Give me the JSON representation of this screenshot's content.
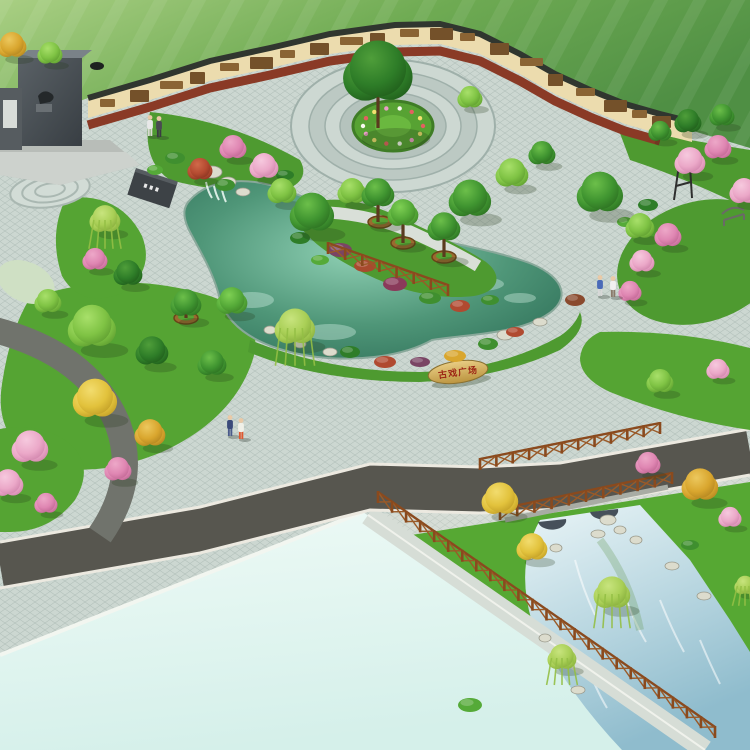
{
  "scene": {
    "kind": "park-landscape-render",
    "stone": {
      "text": "古戏广场",
      "text_color": "#9c2414"
    },
    "palette": {
      "field_light": "#a9cf83",
      "field_dark": "#4f8f44",
      "paving": "#ccd7d1",
      "paving_line": "#b4c2bc",
      "road": "#57564f",
      "curb": "#ece9e0",
      "pool_pale": "#e4f6f1",
      "pond_deep": "#2e6f58",
      "pond_light": "#8fd0b4",
      "canal_light": "#eaf5f7",
      "canal_deep": "#8fbccd",
      "lawn": "#55a433",
      "lawn_deep": "#4e9a30",
      "wall_face": "#ecdcae",
      "wall_coping": "#30362f",
      "mulch": "#8a3a26",
      "mural_a": "#8a6434",
      "mural_b": "#74512a",
      "fence": "#8a4a1e",
      "fence_x": "#9a5a28",
      "rock": "#dcdccd",
      "rock_edge": "#9a9a8c",
      "planter": "#9a6a30",
      "trunk": "#5a3a1e",
      "skin": "#eac9a6",
      "trees": {
        "green_dark": {
          "l": "#4f9e3a",
          "b": "#2e7d28",
          "d": "#1c5417"
        },
        "green": {
          "l": "#6cbf4a",
          "b": "#3f9430",
          "d": "#27661d"
        },
        "green_mid": {
          "l": "#7fd054",
          "b": "#55aa38",
          "d": "#3a7d24"
        },
        "green_light": {
          "l": "#a8e06a",
          "b": "#7fc344",
          "d": "#55932a"
        },
        "yellow": {
          "l": "#f2dc6e",
          "b": "#e2c23c",
          "d": "#b89420"
        },
        "gold": {
          "l": "#ecc85e",
          "b": "#d9a62e",
          "d": "#a87c1c"
        },
        "pink": {
          "l": "#f6c9de",
          "b": "#eba8c8",
          "d": "#c97aa4"
        },
        "pink_deep": {
          "l": "#eda8c8",
          "b": "#df86b2",
          "d": "#b85e8c"
        },
        "red": {
          "l": "#d06a4a",
          "b": "#b44a30",
          "d": "#7d2e1c"
        },
        "willow": {
          "l": "#c8e47e",
          "b": "#a9cf56",
          "d": "#7da436"
        }
      }
    },
    "wall_murals": [
      {
        "x": 100,
        "y": 99
      },
      {
        "x": 130,
        "y": 90
      },
      {
        "x": 160,
        "y": 81
      },
      {
        "x": 190,
        "y": 72
      },
      {
        "x": 220,
        "y": 63
      },
      {
        "x": 250,
        "y": 57
      },
      {
        "x": 280,
        "y": 50
      },
      {
        "x": 310,
        "y": 43
      },
      {
        "x": 340,
        "y": 37
      },
      {
        "x": 370,
        "y": 33
      },
      {
        "x": 400,
        "y": 29
      },
      {
        "x": 430,
        "y": 28
      },
      {
        "x": 460,
        "y": 33
      },
      {
        "x": 490,
        "y": 43
      },
      {
        "x": 520,
        "y": 58
      },
      {
        "x": 548,
        "y": 74
      },
      {
        "x": 576,
        "y": 88
      },
      {
        "x": 604,
        "y": 100
      },
      {
        "x": 632,
        "y": 110
      },
      {
        "x": 652,
        "y": 116
      }
    ],
    "plaza_ring": {
      "cx": 393,
      "cy": 126,
      "rx": 30,
      "ry": 18,
      "count": 14,
      "colors": [
        "#e46060",
        "#f2e070",
        "#eb9ec6",
        "#f8f8f0"
      ]
    },
    "trees": [
      {
        "x": 12,
        "y": 46,
        "r": 15,
        "t": "gold"
      },
      {
        "x": 50,
        "y": 54,
        "r": 13,
        "t": "green_light"
      },
      {
        "x": 378,
        "y": 74,
        "r": 36,
        "t": "green_dark",
        "trunk": 54
      },
      {
        "x": 688,
        "y": 122,
        "r": 14,
        "t": "green_dark"
      },
      {
        "x": 722,
        "y": 116,
        "r": 13,
        "t": "green"
      },
      {
        "x": 660,
        "y": 132,
        "r": 12,
        "t": "green"
      },
      {
        "x": 470,
        "y": 98,
        "r": 13,
        "t": "green_light"
      },
      {
        "x": 200,
        "y": 170,
        "r": 13,
        "t": "red"
      },
      {
        "x": 233,
        "y": 148,
        "r": 14,
        "t": "pink_deep"
      },
      {
        "x": 264,
        "y": 167,
        "r": 15,
        "t": "pink"
      },
      {
        "x": 105,
        "y": 220,
        "r": 16,
        "t": "willow"
      },
      {
        "x": 95,
        "y": 260,
        "r": 13,
        "t": "pink_deep"
      },
      {
        "x": 128,
        "y": 274,
        "r": 15,
        "t": "green_dark"
      },
      {
        "x": 312,
        "y": 214,
        "r": 23,
        "t": "green"
      },
      {
        "x": 282,
        "y": 192,
        "r": 15,
        "t": "green_light"
      },
      {
        "x": 352,
        "y": 192,
        "r": 15,
        "t": "green_light"
      },
      {
        "x": 378,
        "y": 194,
        "r": 17,
        "t": "green",
        "trunk": 28
      },
      {
        "x": 403,
        "y": 214,
        "r": 16,
        "t": "green_mid",
        "trunk": 29
      },
      {
        "x": 444,
        "y": 228,
        "r": 17,
        "t": "green",
        "trunk": 29
      },
      {
        "x": 470,
        "y": 200,
        "r": 22,
        "t": "green"
      },
      {
        "x": 512,
        "y": 174,
        "r": 17,
        "t": "green_light"
      },
      {
        "x": 542,
        "y": 154,
        "r": 14,
        "t": "green"
      },
      {
        "x": 295,
        "y": 328,
        "r": 21,
        "t": "willow"
      },
      {
        "x": 600,
        "y": 194,
        "r": 24,
        "t": "green"
      },
      {
        "x": 640,
        "y": 227,
        "r": 15,
        "t": "green_light"
      },
      {
        "x": 668,
        "y": 236,
        "r": 14,
        "t": "pink_deep"
      },
      {
        "x": 642,
        "y": 262,
        "r": 13,
        "t": "pink"
      },
      {
        "x": 630,
        "y": 292,
        "r": 12,
        "t": "pink_deep"
      },
      {
        "x": 690,
        "y": 162,
        "r": 16,
        "t": "pink"
      },
      {
        "x": 718,
        "y": 148,
        "r": 14,
        "t": "pink_deep"
      },
      {
        "x": 744,
        "y": 192,
        "r": 15,
        "t": "pink"
      },
      {
        "x": 660,
        "y": 382,
        "r": 14,
        "t": "green_light"
      },
      {
        "x": 718,
        "y": 370,
        "r": 12,
        "t": "pink"
      },
      {
        "x": 92,
        "y": 328,
        "r": 25,
        "t": "green_light"
      },
      {
        "x": 48,
        "y": 302,
        "r": 14,
        "t": "green_light"
      },
      {
        "x": 186,
        "y": 304,
        "r": 16,
        "t": "green",
        "trunk": 14
      },
      {
        "x": 232,
        "y": 302,
        "r": 16,
        "t": "green_mid"
      },
      {
        "x": 152,
        "y": 352,
        "r": 17,
        "t": "green_dark"
      },
      {
        "x": 212,
        "y": 364,
        "r": 15,
        "t": "green"
      },
      {
        "x": 95,
        "y": 400,
        "r": 23,
        "t": "yellow"
      },
      {
        "x": 150,
        "y": 434,
        "r": 16,
        "t": "gold"
      },
      {
        "x": 30,
        "y": 448,
        "r": 19,
        "t": "pink"
      },
      {
        "x": 118,
        "y": 470,
        "r": 14,
        "t": "pink_deep"
      },
      {
        "x": 8,
        "y": 484,
        "r": 16,
        "t": "pink"
      },
      {
        "x": 46,
        "y": 504,
        "r": 12,
        "t": "pink_deep"
      },
      {
        "x": 500,
        "y": 500,
        "r": 19,
        "t": "yellow"
      },
      {
        "x": 648,
        "y": 464,
        "r": 13,
        "t": "pink_deep"
      },
      {
        "x": 700,
        "y": 486,
        "r": 19,
        "t": "gold"
      },
      {
        "x": 730,
        "y": 518,
        "r": 12,
        "t": "pink"
      },
      {
        "x": 532,
        "y": 548,
        "r": 16,
        "t": "yellow"
      },
      {
        "x": 612,
        "y": 594,
        "r": 19,
        "t": "willow"
      },
      {
        "x": 562,
        "y": 658,
        "r": 15,
        "t": "willow"
      },
      {
        "x": 745,
        "y": 586,
        "r": 11,
        "t": "willow"
      }
    ],
    "planters": [
      {
        "x": 380,
        "y": 222
      },
      {
        "x": 403,
        "y": 243
      },
      {
        "x": 444,
        "y": 257
      },
      {
        "x": 186,
        "y": 318
      }
    ],
    "shrubs": [
      {
        "x": 175,
        "y": 158,
        "rx": 10,
        "ry": 6,
        "c": "#3f8f2f"
      },
      {
        "x": 155,
        "y": 170,
        "rx": 8,
        "ry": 5,
        "c": "#55aa38"
      },
      {
        "x": 285,
        "y": 175,
        "rx": 9,
        "ry": 5,
        "c": "#2e7d28"
      },
      {
        "x": 225,
        "y": 185,
        "rx": 10,
        "ry": 6,
        "c": "#3f8f2f"
      },
      {
        "x": 340,
        "y": 250,
        "rx": 12,
        "ry": 7,
        "c": "#7a4464"
      },
      {
        "x": 365,
        "y": 266,
        "rx": 11,
        "ry": 6,
        "c": "#a84a2e"
      },
      {
        "x": 395,
        "y": 284,
        "rx": 12,
        "ry": 7,
        "c": "#8a3a5a"
      },
      {
        "x": 430,
        "y": 298,
        "rx": 11,
        "ry": 6,
        "c": "#3f8f2f"
      },
      {
        "x": 300,
        "y": 238,
        "rx": 10,
        "ry": 6,
        "c": "#2e7d28"
      },
      {
        "x": 320,
        "y": 260,
        "rx": 9,
        "ry": 5,
        "c": "#55aa38"
      },
      {
        "x": 460,
        "y": 306,
        "rx": 10,
        "ry": 6,
        "c": "#b04a30"
      },
      {
        "x": 490,
        "y": 300,
        "rx": 9,
        "ry": 5,
        "c": "#3f8f2f"
      },
      {
        "x": 350,
        "y": 352,
        "rx": 10,
        "ry": 6,
        "c": "#2e7d28"
      },
      {
        "x": 385,
        "y": 362,
        "rx": 11,
        "ry": 6,
        "c": "#b04a30"
      },
      {
        "x": 420,
        "y": 362,
        "rx": 10,
        "ry": 5,
        "c": "#7a4464"
      },
      {
        "x": 455,
        "y": 356,
        "rx": 11,
        "ry": 6,
        "c": "#d9a62e"
      },
      {
        "x": 488,
        "y": 344,
        "rx": 10,
        "ry": 6,
        "c": "#3f8f2f"
      },
      {
        "x": 515,
        "y": 332,
        "rx": 9,
        "ry": 5,
        "c": "#b04a30"
      },
      {
        "x": 575,
        "y": 300,
        "rx": 10,
        "ry": 6,
        "c": "#8a4a2e"
      },
      {
        "x": 648,
        "y": 205,
        "rx": 10,
        "ry": 6,
        "c": "#2e7d28"
      },
      {
        "x": 625,
        "y": 222,
        "rx": 8,
        "ry": 5,
        "c": "#55aa38"
      },
      {
        "x": 690,
        "y": 545,
        "rx": 9,
        "ry": 5,
        "c": "#3f8f2f"
      },
      {
        "x": 470,
        "y": 705,
        "rx": 12,
        "ry": 7,
        "c": "#55aa38"
      }
    ],
    "rocks": [
      {
        "x": 212,
        "y": 172,
        "rx": 10,
        "ry": 6
      },
      {
        "x": 228,
        "y": 182,
        "rx": 8,
        "ry": 5
      },
      {
        "x": 243,
        "y": 192,
        "rx": 7,
        "ry": 4
      },
      {
        "x": 330,
        "y": 352,
        "rx": 7,
        "ry": 4
      },
      {
        "x": 300,
        "y": 344,
        "rx": 6,
        "ry": 4
      },
      {
        "x": 505,
        "y": 335,
        "rx": 8,
        "ry": 5
      },
      {
        "x": 540,
        "y": 322,
        "rx": 7,
        "ry": 4
      },
      {
        "x": 270,
        "y": 330,
        "rx": 6,
        "ry": 4
      },
      {
        "x": 528,
        "y": 556,
        "rx": 7,
        "ry": 4
      },
      {
        "x": 556,
        "y": 548,
        "rx": 6,
        "ry": 4
      },
      {
        "x": 598,
        "y": 534,
        "rx": 7,
        "ry": 4
      },
      {
        "x": 636,
        "y": 540,
        "rx": 6,
        "ry": 4
      },
      {
        "x": 672,
        "y": 566,
        "rx": 7,
        "ry": 4
      },
      {
        "x": 704,
        "y": 596,
        "rx": 7,
        "ry": 4
      },
      {
        "x": 545,
        "y": 638,
        "rx": 6,
        "ry": 4
      },
      {
        "x": 578,
        "y": 690,
        "rx": 7,
        "ry": 4
      },
      {
        "x": 620,
        "y": 530,
        "rx": 6,
        "ry": 4
      },
      {
        "x": 608,
        "y": 520,
        "rx": 8,
        "ry": 5
      }
    ],
    "fences": [
      {
        "x1": 328,
        "y1": 252,
        "x2": 448,
        "y2": 294
      },
      {
        "x1": 378,
        "y1": 501,
        "x2": 715,
        "y2": 736
      },
      {
        "x1": 480,
        "y1": 468,
        "x2": 660,
        "y2": 432
      },
      {
        "x1": 500,
        "y1": 518,
        "x2": 672,
        "y2": 482
      }
    ],
    "people": [
      {
        "x": 150,
        "y": 124,
        "top": "#e8e8e8",
        "bottom": "#d8d8d0"
      },
      {
        "x": 159,
        "y": 125,
        "top": "#4a4a52",
        "bottom": "#3a3a42"
      },
      {
        "x": 230,
        "y": 424,
        "top": "#3a4a7a",
        "bottom": "#4a5a8a"
      },
      {
        "x": 241,
        "y": 427,
        "top": "#f0f0e8",
        "bottom": "#e05830"
      },
      {
        "x": 600,
        "y": 284,
        "top": "#4a6ab8",
        "bottom": "#d8d8d8"
      },
      {
        "x": 613,
        "y": 285,
        "top": "#f0f0f0",
        "bottom": "#8a7a6a"
      }
    ]
  }
}
